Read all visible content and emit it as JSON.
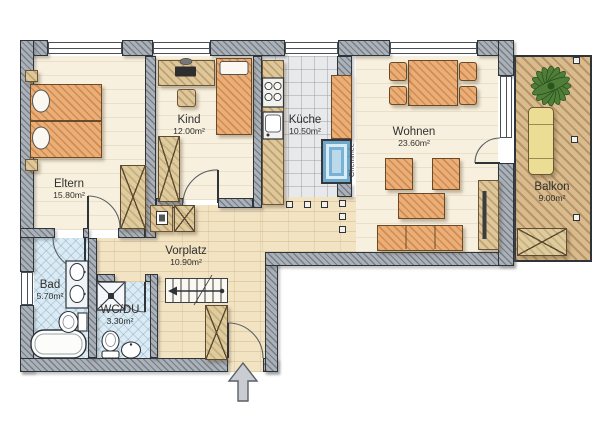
{
  "rooms": {
    "eltern": {
      "label": "Eltern",
      "area": "15.80m²"
    },
    "kind": {
      "label": "Kind",
      "area": "12.00m²"
    },
    "kueche": {
      "label": "Küche",
      "area": "10.50m²"
    },
    "wohnen": {
      "label": "Wohnen",
      "area": "23.60m²"
    },
    "balkon": {
      "label": "Balkon",
      "area": "9.00m²"
    },
    "vorplatz": {
      "label": "Vorplatz",
      "area": "10.90m²"
    },
    "bad": {
      "label": "Bad",
      "area": "5.70m²"
    },
    "wcdu": {
      "label": "WC/DU",
      "area": "3.30m²"
    }
  },
  "annotations": {
    "cheminee": "Cheminée"
  },
  "colors": {
    "wall": "#aab1b8",
    "wall_outline": "#2f3439",
    "floor_cream": "#f8f0de",
    "floor_hall": "#f2e3c3",
    "floor_tile": "#e8e9eb",
    "floor_bath": "#dcebf3",
    "deck": "#d9bb8e",
    "furniture_orange": "#eaaf79",
    "furniture_wood": "#dfc79c",
    "fireplace_blue": "#79b2d6",
    "lounger_yellow": "#ecdd94",
    "plant_green": "#4f7e38",
    "text": "#30302e"
  }
}
